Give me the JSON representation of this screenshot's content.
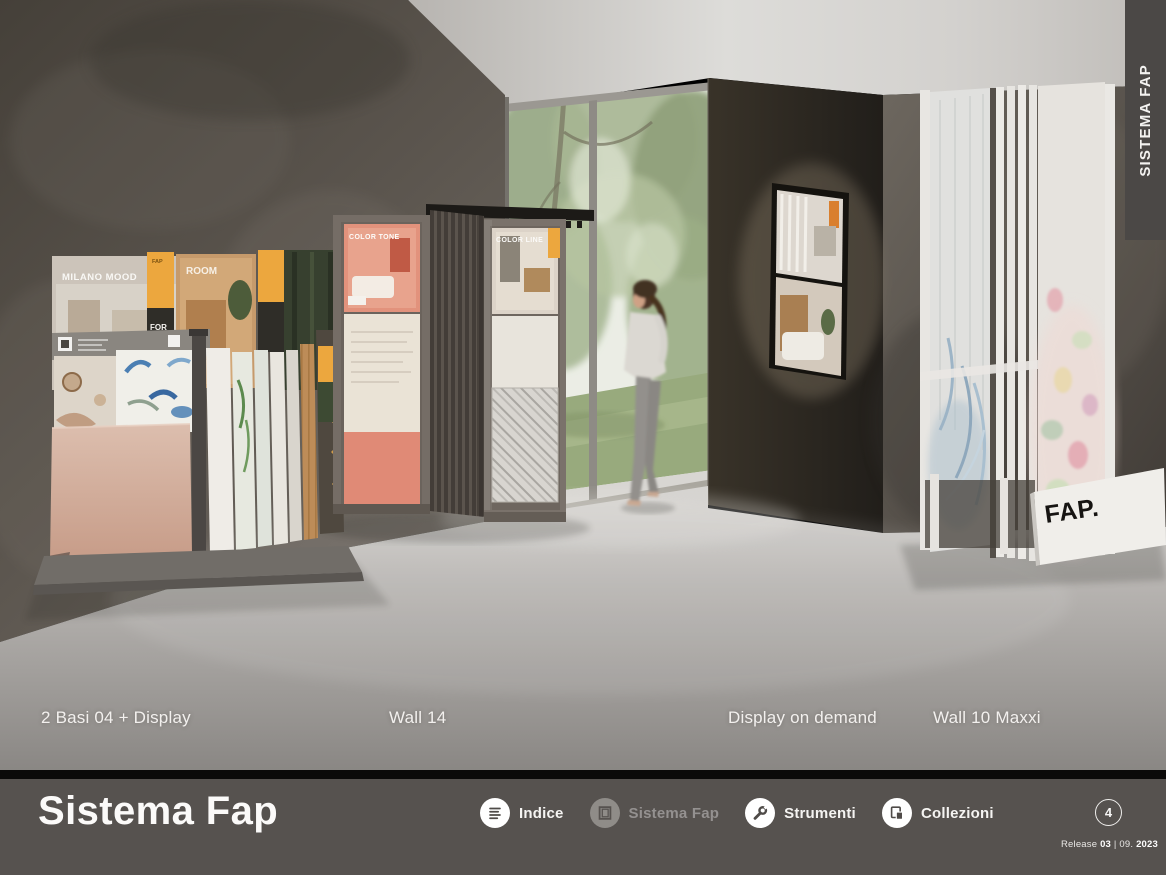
{
  "side_tab": {
    "label": "SISTEMA FAP"
  },
  "photo": {
    "captions": [
      "2 Basi 04 + Display",
      "Wall 14",
      "Display on demand",
      "Wall 10 Maxxi"
    ],
    "posters": {
      "milano_mood": "MILANO MOOD",
      "room": "ROOM",
      "color_tone": "COLOR TONE",
      "color_line": "COLOR LINE",
      "tag_fap": "FAP",
      "tag_for": "FOR",
      "tag_tiles": "TILES",
      "base_logo": "FAP."
    }
  },
  "footer": {
    "title": "Sistema Fap",
    "nav": [
      {
        "label": "Indice",
        "icon": "index-list-icon",
        "state": "enabled"
      },
      {
        "label": "Sistema Fap",
        "icon": "display-frame-icon",
        "state": "current"
      },
      {
        "label": "Strumenti",
        "icon": "wrench-icon",
        "state": "enabled"
      },
      {
        "label": "Collezioni",
        "icon": "collections-copy-icon",
        "state": "enabled"
      }
    ],
    "page_number": "4",
    "release": {
      "label": "Release",
      "version": "03",
      "separator": "|",
      "month": "09.",
      "year": "2023"
    }
  },
  "colors": {
    "footer_bg": "#56524f",
    "tab_bg": "#4b4846",
    "accent_orange": "#eca73e",
    "caption_text": "#f7f5f2",
    "disabled_nav": "#949190"
  }
}
